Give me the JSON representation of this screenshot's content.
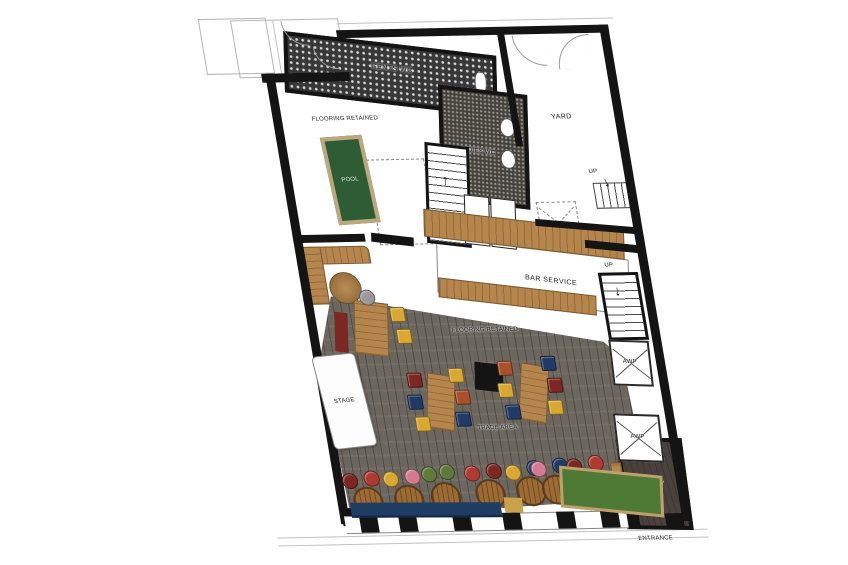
{
  "meta": {
    "description": "Ground floor plan of a bar venue with trade area, bar service, pool room, WCs, yard and lobby"
  },
  "glyphs": {
    "arrow_up": "↑",
    "arrow_down": "↓"
  },
  "labels": {
    "flooring_retained_upper": "FLOORING RETAINED",
    "pool": "POOL",
    "gents_wc": "GENTS WC",
    "ladies_wc": "LADIES WC",
    "yard": "YARD",
    "up_main_stairs": "UP",
    "up_yard_stairs": "UP",
    "up_right_stairs": "UP",
    "bar_service": "BAR SERVICE",
    "flooring_retained_lower": "FLOORING RETAINED",
    "stage": "STAGE",
    "trade_area": "TRADE AREA",
    "awp_upper": "AWP",
    "awp_lower": "AWP",
    "lobby": "LOBBY",
    "entrance": "ENTRANCE"
  },
  "colors": {
    "wall": "#141414",
    "wood": "#b5854e",
    "pool_table": "#2e5c35",
    "trade_floor": "#6b665e",
    "bench_blue": "#1d3d63",
    "bench_green": "#4f7a35",
    "bench_maroon": "#7c2722",
    "bench_yellow": "#c9a24a",
    "lobby_floor": "#4a413c",
    "stool_rust": "#a8502a",
    "stool_yellow": "#d9a832",
    "stool_navy": "#1f3a66",
    "stool_maroon": "#7c2722",
    "stool_red": "#b03a32",
    "stool_pink": "#d47b90",
    "stool_green": "#5d7a3a",
    "stool_gray": "#9a9a9a"
  }
}
